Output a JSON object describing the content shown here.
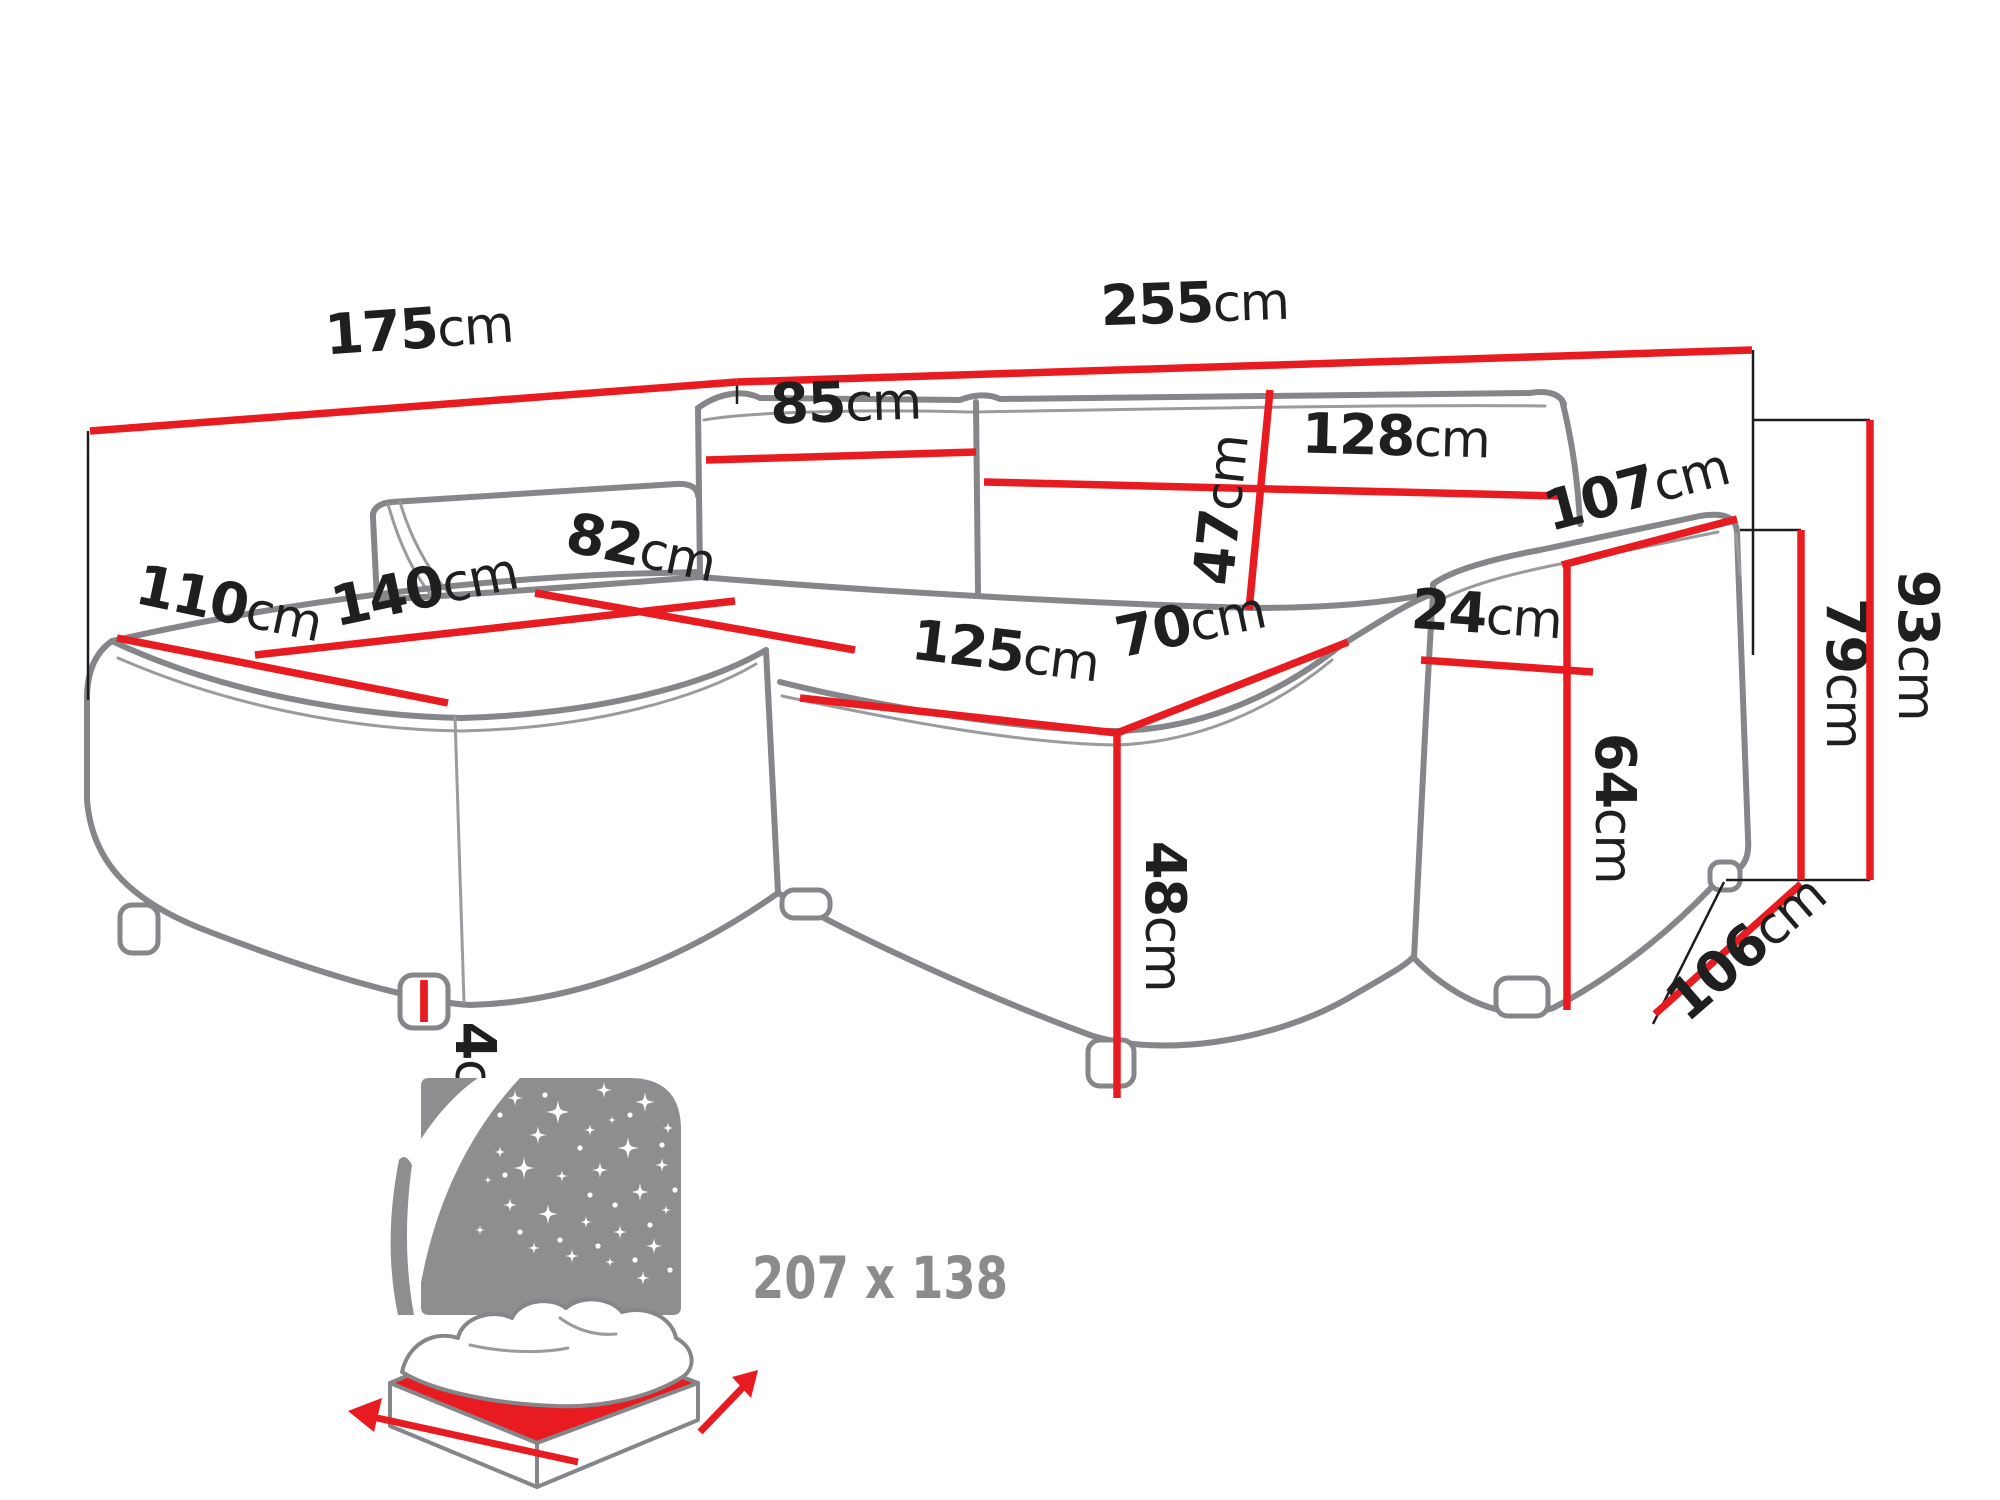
{
  "colors": {
    "dimension_red": "#e81c20",
    "outline_gray": "#85868a",
    "icon_gray": "#8d8e90",
    "label_black": "#1f1f20",
    "size_text_gray": "#8a8b8d",
    "background": "#ffffff"
  },
  "diagram": {
    "unit": "cm",
    "dimensions": [
      {
        "id": "left-side-width",
        "value": "175",
        "unit": "cm",
        "line": {
          "x1": 90,
          "y1": 431,
          "x2": 737,
          "y2": 382
        },
        "label": {
          "x": 420,
          "y": 348,
          "rotate": -4
        }
      },
      {
        "id": "front-width",
        "value": "255",
        "unit": "cm",
        "line": {
          "x1": 737,
          "y1": 382,
          "x2": 1752,
          "y2": 350
        },
        "label": {
          "x": 1195,
          "y": 322,
          "rotate": -2
        }
      },
      {
        "id": "left-backrest-cushion",
        "value": "85",
        "unit": "cm",
        "line": {
          "x1": 706,
          "y1": 460,
          "x2": 976,
          "y2": 452
        },
        "label": {
          "x": 846,
          "y": 421,
          "rotate": -2
        }
      },
      {
        "id": "right-backrest-cushion",
        "value": "128",
        "unit": "cm",
        "line": {
          "x1": 984,
          "y1": 482,
          "x2": 1560,
          "y2": 496
        },
        "label": {
          "x": 1395,
          "y": 455,
          "rotate": 1.5
        }
      },
      {
        "id": "backrest-cushion-height",
        "value": "47",
        "unit": "cm",
        "line": {
          "x1": 1270,
          "y1": 390,
          "x2": 1249,
          "y2": 610
        },
        "label": {
          "x": 1240,
          "y": 512,
          "rotate": -84
        }
      },
      {
        "id": "armrest-length",
        "value": "107",
        "unit": "cm",
        "line": {
          "x1": 1562,
          "y1": 565,
          "x2": 1737,
          "y2": 519
        },
        "label": {
          "x": 1641,
          "y": 507,
          "rotate": -15
        }
      },
      {
        "id": "armrest-width",
        "value": "24",
        "unit": "cm",
        "line": {
          "x1": 1421,
          "y1": 660,
          "x2": 1593,
          "y2": 672
        },
        "label": {
          "x": 1485,
          "y": 633,
          "rotate": 4
        }
      },
      {
        "id": "armrest-side-height",
        "value": "64",
        "unit": "cm",
        "line": {
          "x1": 1567,
          "y1": 565,
          "x2": 1567,
          "y2": 1010
        },
        "label": {
          "x": 1596,
          "y": 808,
          "rotate": 90
        }
      },
      {
        "id": "armrest-height",
        "value": "79",
        "unit": "cm",
        "line": {
          "x1": 1801,
          "y1": 530,
          "x2": 1801,
          "y2": 880
        },
        "label": {
          "x": 1827,
          "y": 673,
          "rotate": 90
        }
      },
      {
        "id": "total-height",
        "value": "93",
        "unit": "cm",
        "line": {
          "x1": 1870,
          "y1": 420,
          "x2": 1870,
          "y2": 880
        },
        "label": {
          "x": 1899,
          "y": 645,
          "rotate": 90
        }
      },
      {
        "id": "right-side-depth",
        "value": "106",
        "unit": "cm",
        "line": {
          "x1": 1655,
          "y1": 1014,
          "x2": 1801,
          "y2": 884
        },
        "label": {
          "x": 1758,
          "y": 962,
          "rotate": -41
        }
      },
      {
        "id": "chaise-front-width",
        "value": "110",
        "unit": "cm",
        "line": {
          "x1": 117,
          "y1": 638,
          "x2": 448,
          "y2": 703
        },
        "label": {
          "x": 225,
          "y": 622,
          "rotate": 12
        }
      },
      {
        "id": "chaise-length",
        "value": "140",
        "unit": "cm",
        "line": {
          "x1": 255,
          "y1": 655,
          "x2": 735,
          "y2": 601
        },
        "label": {
          "x": 428,
          "y": 607,
          "rotate": -12
        }
      },
      {
        "id": "chaise-seat-depth",
        "value": "82",
        "unit": "cm",
        "line": {
          "x1": 535,
          "y1": 593,
          "x2": 855,
          "y2": 650
        },
        "label": {
          "x": 637,
          "y": 566,
          "rotate": 12
        }
      },
      {
        "id": "seat-front-width",
        "value": "125",
        "unit": "cm",
        "line": {
          "x1": 800,
          "y1": 698,
          "x2": 1117,
          "y2": 733
        },
        "label": {
          "x": 1003,
          "y": 670,
          "rotate": 7
        }
      },
      {
        "id": "seat-depth",
        "value": "70",
        "unit": "cm",
        "line": {
          "x1": 1117,
          "y1": 733,
          "x2": 1348,
          "y2": 642
        },
        "label": {
          "x": 1194,
          "y": 642,
          "rotate": -12
        }
      },
      {
        "id": "seat-height",
        "value": "48",
        "unit": "cm",
        "line": {
          "x1": 1117,
          "y1": 733,
          "x2": 1117,
          "y2": 1098
        },
        "label": {
          "x": 1146,
          "y": 916,
          "rotate": 90
        }
      },
      {
        "id": "leg-height",
        "value": "4",
        "unit": "cm",
        "line": {
          "x1": 424,
          "y1": 980,
          "x2": 424,
          "y2": 1022
        },
        "label": {
          "x": 456,
          "y": 1078,
          "rotate": 90
        }
      }
    ],
    "sleeping_area": {
      "text": "207 x 138"
    }
  }
}
